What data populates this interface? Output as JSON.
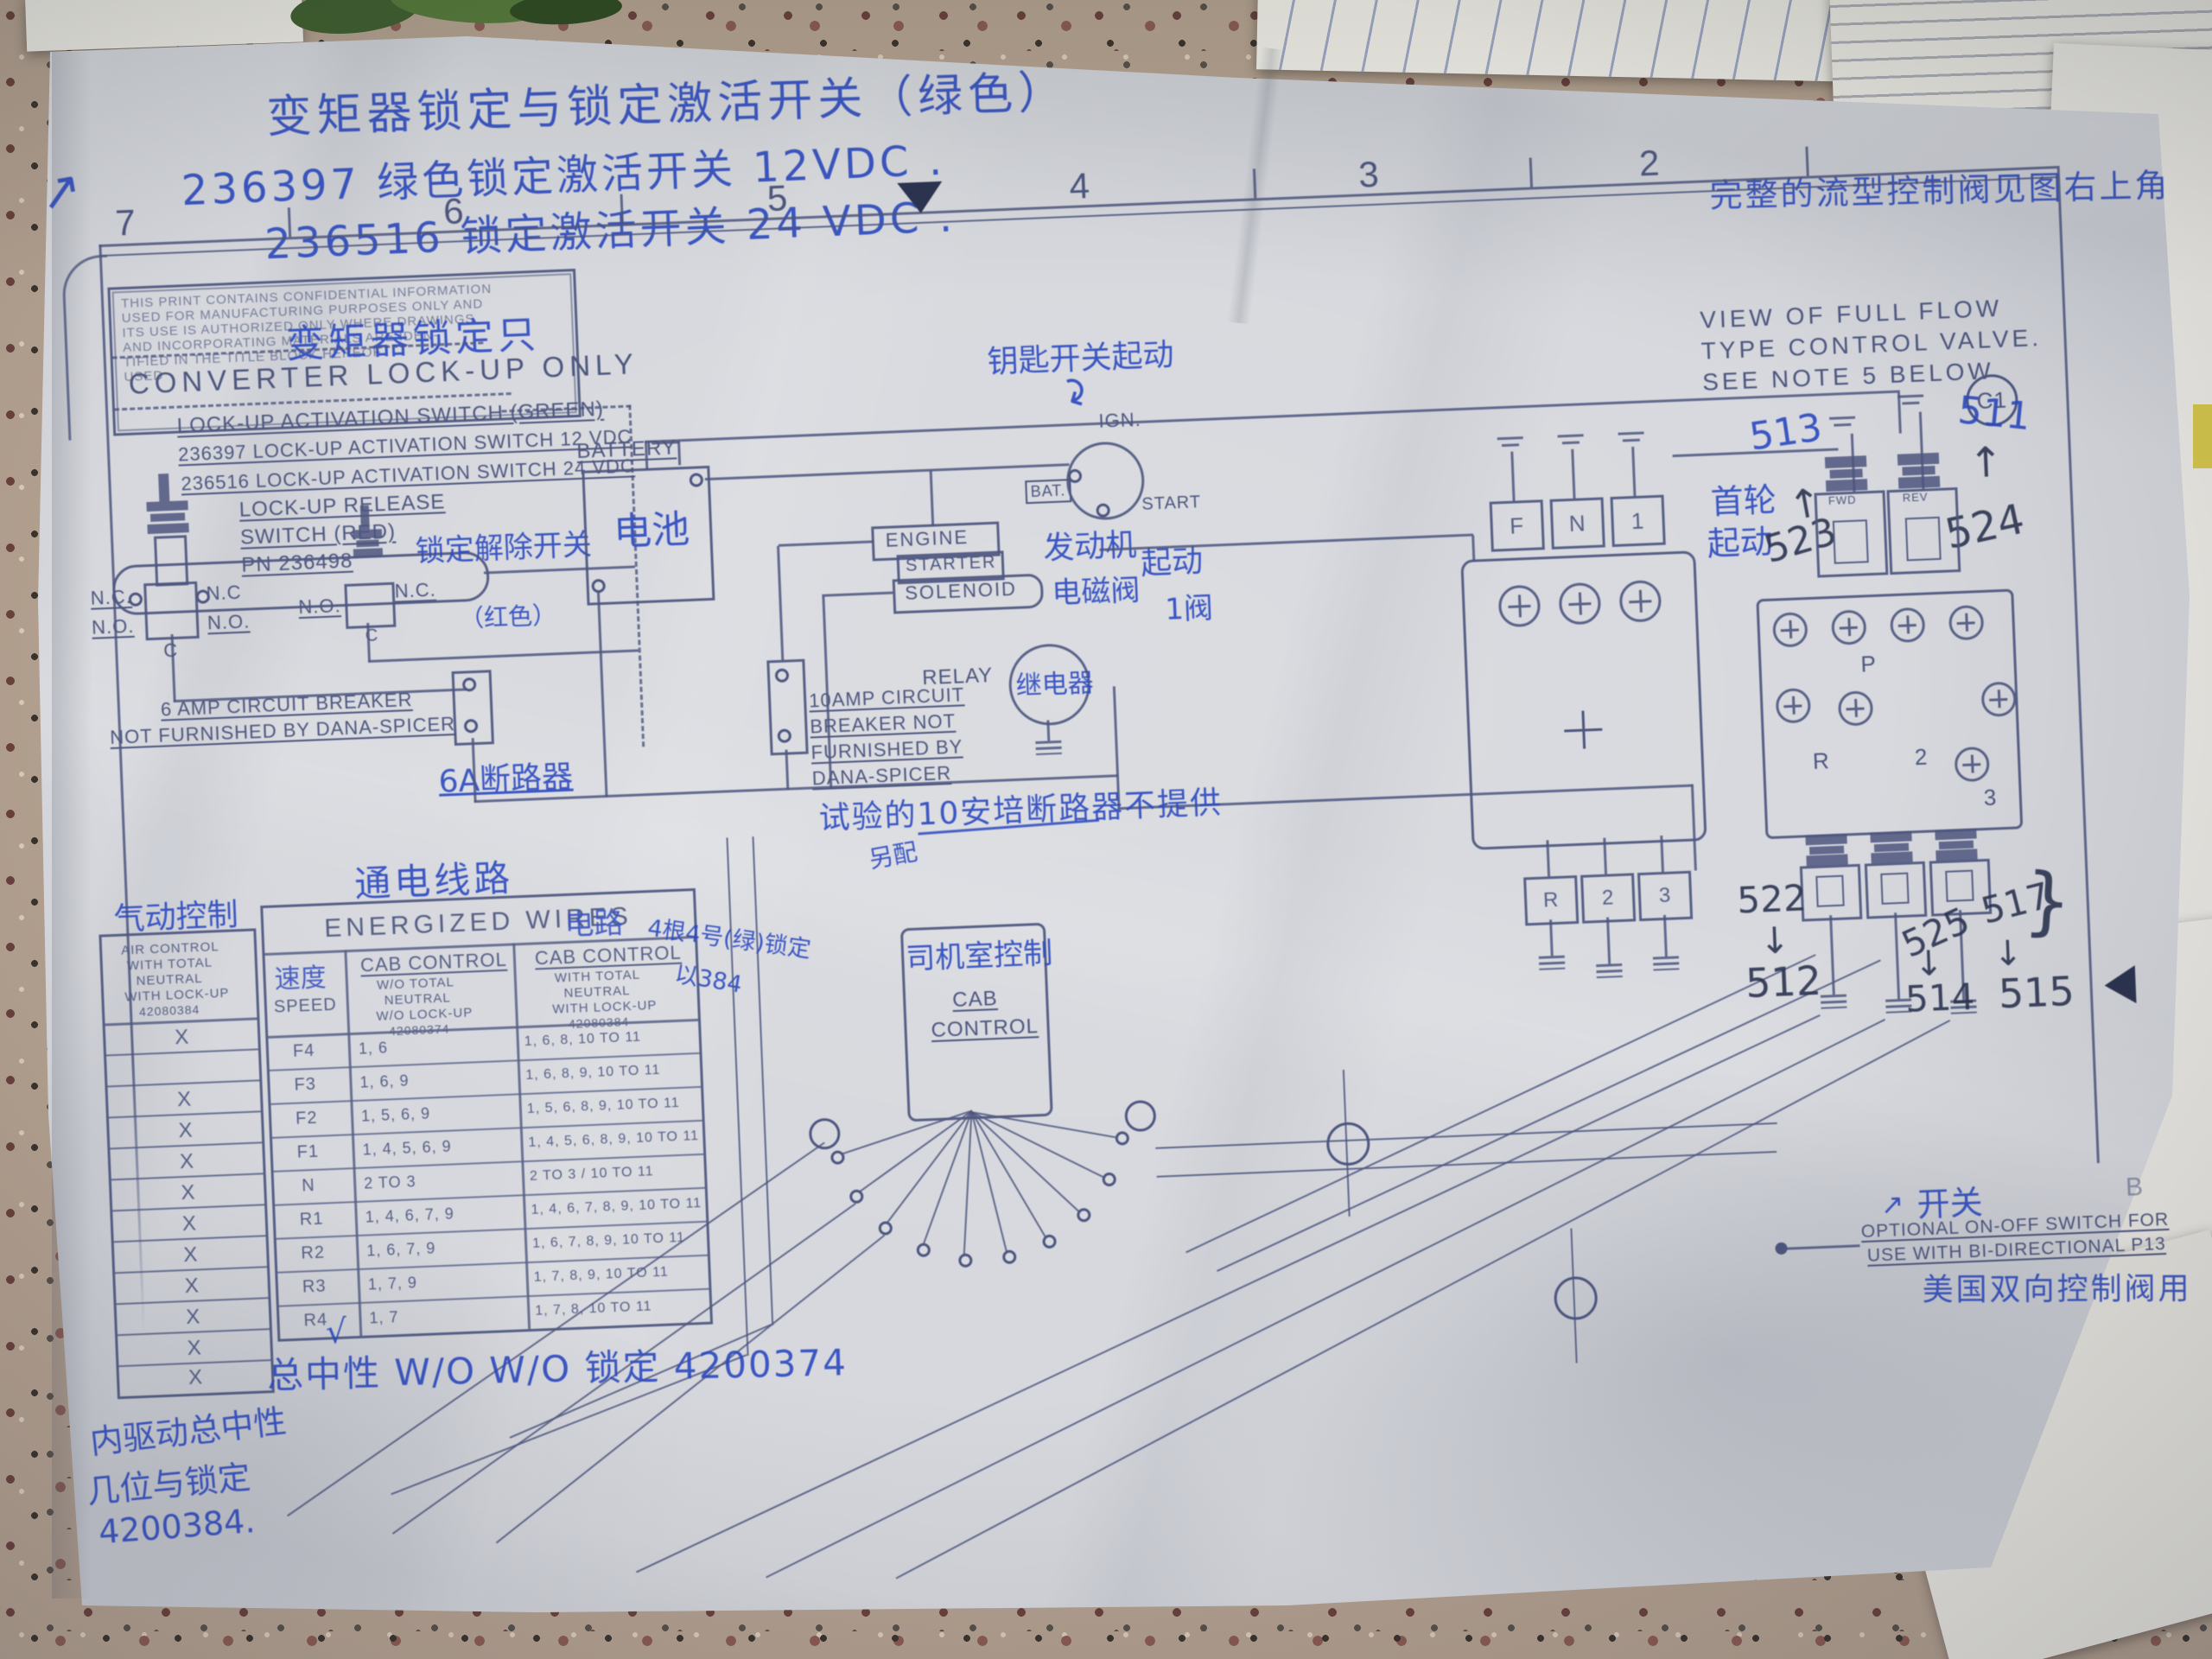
{
  "labels": {
    "nc": "N.C.",
    "nc2": "N.C",
    "no": "N.O.",
    "c": "C"
  },
  "ruler": {
    "n7": "7",
    "n6": "6",
    "n5": "5",
    "n4": "4",
    "n3": "3",
    "n2": "2"
  },
  "notes_top": {
    "line1": "变矩器锁定与锁定激活开关（绿色）",
    "line2": "236397 绿色锁定激活开关 12VDC .",
    "line3": "236516 锁定激活开关 24 VDC .",
    "right": "完整的流型控制阀见图右上角"
  },
  "confidential": {
    "l1": "THIS PRINT CONTAINS CONFIDENTIAL INFORMATION",
    "l2": "USED FOR MANUFACTURING PURPOSES ONLY AND",
    "l3": "ITS USE IS AUTHORIZED ONLY WHERE DRAWINGS",
    "l4": "AND INCORPORATING MATERIALS ARE IDEN-",
    "l5": "TIFIED IN THE TITLE BLOCK HEREOF",
    "l6": "USED"
  },
  "lockup": {
    "hw_title": "变矩器锁定只",
    "title": "CONVERTER  LOCK-UP  ONLY",
    "switch_green": "LOCK-UP  ACTIVATION  SWITCH  (GREEN)",
    "switch_12": "236397   LOCK-UP  ACTIVATION  SWITCH  12 VDC",
    "switch_24": "236516   LOCK-UP  ACTIVATION  SWITCH  24 VDC"
  },
  "release": {
    "l1": "LOCK-UP  RELEASE",
    "l2": "SWITCH (RED)",
    "l3": "PN 236498",
    "hw": "锁定解除开关",
    "hw2": "（红色）"
  },
  "breaker6": {
    "l1": "6 AMP CIRCUIT BREAKER",
    "l2": "NOT FURNISHED BY DANA-SPICER",
    "hw": "6A断路器"
  },
  "battery": {
    "label": "BATTERY",
    "hw": "电池"
  },
  "ignition": {
    "ign": "IGN.",
    "bat": "BAT.",
    "start": "START",
    "hw": "钥匙开关起动"
  },
  "starter": {
    "l1": "ENGINE",
    "l2": "STARTER",
    "l3": "SOLENOID",
    "hw1": "发动机",
    "hw2": "起动",
    "hw3": "电磁阀",
    "hw4": "1阀"
  },
  "relay": {
    "label": "RELAY",
    "hw": "继电器"
  },
  "breaker10": {
    "l1": "10AMP CIRCUIT",
    "l2": "BREAKER  NOT",
    "l3": "FURNISHED  BY",
    "l4": "DANA-SPICER",
    "hw": "试验的10安培断路器不提供",
    "hw2": "另配"
  },
  "cab": {
    "l1": "CAB",
    "l2": "CONTROL",
    "hw": "司机室控制"
  },
  "view_note": {
    "l1": "VIEW  OF  FULL  FLOW",
    "l2": "TYPE  CONTROL  VALVE.",
    "l3": "SEE  NOTE  5  BELOW",
    "c1": "C1",
    "b": "B"
  },
  "assembly": {
    "f": "F",
    "n": "N",
    "one": "1",
    "r": "R",
    "two": "2",
    "three": "3"
  },
  "valve": {
    "fwd": "FWD",
    "rev": "REV",
    "p": "P",
    "r": "R",
    "two": "2",
    "three": "3",
    "hw1": "首轮",
    "hw2": "起动",
    "n513": "513",
    "n511": "511",
    "n523": "523",
    "n524": "524",
    "n522": "522",
    "n512": "512",
    "n525": "525",
    "n514": "514",
    "n517": "517",
    "n515": "515",
    "brace": "}"
  },
  "optional": {
    "l1": "OPTIONAL  ON-OFF  SWITCH  FOR",
    "l2": "USE  WITH  BI-DIRECTIONAL  P13",
    "hw_top": "开关",
    "hw_bottom": "美国双向控制阀用"
  },
  "table": {
    "hw_above": "通电线路",
    "hw_suffix": "电路",
    "hw_speed": "速度",
    "hw_right1": "4根4号(绿)锁定",
    "hw_right2": "以384",
    "title": "ENERGIZED  WIRES",
    "col_speed": "SPEED",
    "col2": {
      "h": "CAB CONTROL",
      "s1": "W/O TOTAL",
      "s2": "NEUTRAL",
      "s3": "W/O LOCK-UP",
      "pn": "42080374"
    },
    "col3": {
      "h": "CAB CONTROL",
      "s1": "WITH TOTAL",
      "s2": "NEUTRAL",
      "s3": "WITH LOCK-UP",
      "pn": "42080384"
    },
    "rows": [
      {
        "s": "F4",
        "a": "1, 6",
        "b": "1, 6, 8,  10 TO 11"
      },
      {
        "s": "F3",
        "a": "1, 6, 9",
        "b": "1, 6, 8, 9,  10 TO 11"
      },
      {
        "s": "F2",
        "a": "1, 5, 6, 9",
        "b": "1, 5, 6, 8, 9,  10 TO 11"
      },
      {
        "s": "F1",
        "a": "1, 4, 5, 6, 9",
        "b": "1, 4, 5, 6, 8, 9,  10 TO 11"
      },
      {
        "s": "N",
        "a": "2 TO 3",
        "b": "2 TO 3  /  10 TO 11"
      },
      {
        "s": "R1",
        "a": "1, 4, 6, 7, 9",
        "b": "1, 4, 6, 7, 8, 9,  10 TO 11"
      },
      {
        "s": "R2",
        "a": "1, 6, 7, 9",
        "b": "1, 6, 7, 8, 9,  10 TO 11"
      },
      {
        "s": "R3",
        "a": "1, 7, 9",
        "b": "1, 7, 8, 9,  10 TO 11"
      },
      {
        "s": "R4",
        "a": "1, 7",
        "b": "1, 7, 8,  10 TO 11"
      }
    ]
  },
  "left_table": {
    "hw": "气动控制",
    "header": {
      "h1": "AIR CONTROL",
      "h2": "WITH TOTAL",
      "h3": "NEUTRAL",
      "h4": "WITH LOCK-UP",
      "h5": "42080384"
    },
    "marks": [
      "X",
      "",
      "X",
      "X",
      "X",
      "X",
      "X",
      "X",
      "X",
      "X",
      "X",
      "X"
    ]
  },
  "notes_bottom": {
    "check": "√",
    "center": "总中性 W/O W/O 锁定 4200374",
    "l1": "内驱动总中性",
    "l2": "几位与锁定",
    "l3": "4200384."
  },
  "arrows": {
    "up": "↑",
    "down": "↓",
    "ne": "↗",
    "curve": "↷"
  }
}
